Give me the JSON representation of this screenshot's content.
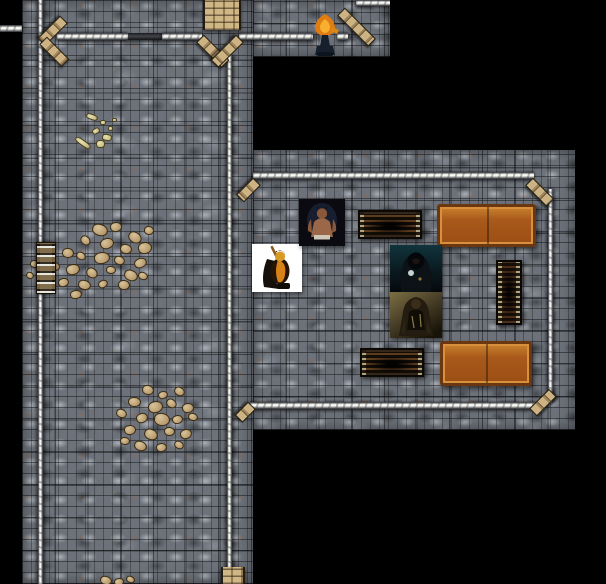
{
  "scene": {
    "kind": "dungeon-map",
    "width": 606,
    "height": 584,
    "background": "#000000",
    "grid": {
      "size": 32.7,
      "line_color": "rgba(8,9,11,0.48)"
    }
  },
  "palette": {
    "floor_stone": "#6d727a",
    "wall_highlight": "#ffffff",
    "wall_shadow": "#232428",
    "corner_wood": "#cdb284",
    "table_bright": "#a8591b",
    "table_dark": "#1d140c",
    "rubble_stone": "#b89a6e",
    "hero_background": "#ffffff",
    "flame_orange": "#f29a18"
  },
  "floors": [
    {
      "name": "west-hall-floor",
      "x": 22,
      "y": 0,
      "w": 231,
      "h": 584,
      "gx": 19,
      "gy": 30
    },
    {
      "name": "north-corridor-floor",
      "x": 253,
      "y": 0,
      "w": 137,
      "h": 57,
      "gx": 17,
      "gy": 30
    },
    {
      "name": "east-room-floor",
      "x": 253,
      "y": 150,
      "w": 322,
      "h": 280,
      "gx": 17,
      "gy": 11
    }
  ],
  "walls": [
    {
      "name": "west-edge-wall-stub",
      "x": 0,
      "y": 25,
      "w": 22,
      "h": 7,
      "o": "h"
    },
    {
      "name": "west-wall",
      "x": 38,
      "y": 0,
      "w": 5,
      "h": 584,
      "o": "v"
    },
    {
      "name": "north-wall-west",
      "x": 57,
      "y": 33,
      "w": 71,
      "h": 7,
      "o": "h"
    },
    {
      "name": "north-wall-gap-shadow",
      "x": 128,
      "y": 33,
      "w": 34,
      "h": 7,
      "o": "h",
      "dark": true
    },
    {
      "name": "north-wall-mid",
      "x": 162,
      "y": 33,
      "w": 40,
      "h": 7,
      "o": "h"
    },
    {
      "name": "north-wall-east",
      "x": 239,
      "y": 33,
      "w": 74,
      "h": 7,
      "o": "h"
    },
    {
      "name": "north-wall-far-east",
      "x": 337,
      "y": 33,
      "w": 11,
      "h": 7,
      "o": "h"
    },
    {
      "name": "north-edge-wall-stub",
      "x": 356,
      "y": 0,
      "w": 34,
      "h": 6,
      "o": "h"
    },
    {
      "name": "west-hall-east-wall",
      "x": 227,
      "y": 55,
      "w": 5,
      "h": 529,
      "o": "v"
    },
    {
      "name": "east-room-north-wall",
      "x": 253,
      "y": 172,
      "w": 281,
      "h": 7,
      "o": "h"
    },
    {
      "name": "east-room-east-wall",
      "x": 548,
      "y": 189,
      "w": 5,
      "h": 214,
      "o": "v"
    },
    {
      "name": "east-room-south-wall",
      "x": 250,
      "y": 402,
      "w": 286,
      "h": 7,
      "o": "h"
    }
  ],
  "diagonals": [
    {
      "name": "northwest-corner-upper",
      "x": 64,
      "y": 14,
      "len": 30,
      "deg": 135
    },
    {
      "name": "northwest-corner-lower",
      "x": 43,
      "y": 35,
      "len": 30,
      "deg": 45
    },
    {
      "name": "stair-funnel-west",
      "x": 200,
      "y": 33,
      "len": 34,
      "deg": 45
    },
    {
      "name": "stair-funnel-east",
      "x": 240,
      "y": 33,
      "len": 34,
      "deg": 135
    },
    {
      "name": "north-corridor-corner",
      "x": 341,
      "y": 6,
      "len": 42,
      "deg": 45
    },
    {
      "name": "east-room-nw-corner",
      "x": 257,
      "y": 176,
      "len": 22,
      "deg": 135
    },
    {
      "name": "east-room-ne-corner",
      "x": 529,
      "y": 176,
      "len": 28,
      "deg": 45
    },
    {
      "name": "east-room-se-corner",
      "x": 533,
      "y": 407,
      "len": 26,
      "deg": -45
    },
    {
      "name": "east-room-sw-corner",
      "x": 252,
      "y": 400,
      "len": 17,
      "deg": 135
    }
  ],
  "stairs": [
    {
      "name": "staircase-north",
      "x": 203,
      "y": 0,
      "w": 34,
      "h": 30
    },
    {
      "name": "staircase-south",
      "x": 221,
      "y": 567,
      "w": 20,
      "h": 17
    }
  ],
  "ladders": [
    {
      "name": "ladder-west-wall",
      "x": 36,
      "y": 242,
      "w": 18,
      "h": 50
    }
  ],
  "tokens": [
    {
      "id": "hero",
      "name": "hero-warrior-token",
      "desc": "armored warrior with raised sword on white tile",
      "x": 252,
      "y": 244,
      "w": 50,
      "h": 48
    },
    {
      "id": "brazier",
      "name": "flaming-statue-token",
      "desc": "orange flame statue on dark pedestal",
      "x": 310,
      "y": 13,
      "w": 30,
      "h": 44
    },
    {
      "id": "barbarian",
      "name": "barbarian-token",
      "desc": "shirtless barbarian portrait on dark tile",
      "x": 299,
      "y": 199,
      "w": 46,
      "h": 47
    },
    {
      "id": "hooded",
      "name": "hooded-figure-token",
      "desc": "hooded figure on teal-black tile",
      "x": 390,
      "y": 245,
      "w": 52,
      "h": 47
    },
    {
      "id": "brute",
      "name": "armored-brute-token",
      "desc": "dark armored brute on olive tile",
      "x": 390,
      "y": 292,
      "w": 52,
      "h": 46
    }
  ],
  "furniture": [
    {
      "type": "table-dark",
      "name": "weathered-table-north",
      "x": 358,
      "y": 210,
      "w": 60,
      "h": 25
    },
    {
      "type": "table-bright",
      "name": "wooden-table-north",
      "x": 437,
      "y": 204,
      "w": 93,
      "h": 37
    },
    {
      "type": "cabinet",
      "name": "cabinet-east",
      "x": 496,
      "y": 260,
      "w": 22,
      "h": 61
    },
    {
      "type": "table-dark",
      "name": "weathered-table-south",
      "x": 360,
      "y": 348,
      "w": 60,
      "h": 25
    },
    {
      "type": "table-bright",
      "name": "wooden-table-south",
      "x": 440,
      "y": 341,
      "w": 86,
      "h": 39
    }
  ],
  "rubble_patches": [
    {
      "name": "debris-scatter-north",
      "kind": "debris",
      "x": 72,
      "y": 112,
      "stones": [
        [
          14,
          2,
          10,
          4,
          20
        ],
        [
          28,
          8,
          4,
          3,
          0
        ],
        [
          36,
          14,
          3,
          3,
          0
        ],
        [
          20,
          16,
          6,
          4,
          -30
        ],
        [
          2,
          28,
          16,
          4,
          35
        ],
        [
          30,
          22,
          8,
          5,
          10
        ],
        [
          40,
          6,
          3,
          2,
          0
        ],
        [
          24,
          28,
          7,
          6,
          0
        ]
      ]
    },
    {
      "name": "rubble-pile-west",
      "kind": "rocks",
      "x": 50,
      "y": 222,
      "stones": [
        [
          -20,
          38,
          8,
          6,
          0
        ],
        [
          -24,
          50,
          6,
          5,
          20
        ],
        [
          42,
          2,
          14,
          10,
          15
        ],
        [
          60,
          0,
          10,
          8,
          -10
        ],
        [
          78,
          10,
          12,
          9,
          30
        ],
        [
          94,
          4,
          8,
          7,
          0
        ],
        [
          30,
          14,
          9,
          7,
          40
        ],
        [
          50,
          16,
          12,
          9,
          -20
        ],
        [
          70,
          22,
          10,
          8,
          10
        ],
        [
          88,
          20,
          12,
          10,
          -15
        ],
        [
          12,
          26,
          10,
          8,
          0
        ],
        [
          26,
          30,
          8,
          6,
          25
        ],
        [
          44,
          30,
          14,
          10,
          -10
        ],
        [
          64,
          34,
          9,
          7,
          15
        ],
        [
          84,
          36,
          11,
          8,
          -25
        ],
        [
          0,
          40,
          8,
          7,
          10
        ],
        [
          16,
          42,
          12,
          9,
          -15
        ],
        [
          36,
          46,
          10,
          8,
          30
        ],
        [
          56,
          44,
          8,
          6,
          0
        ],
        [
          74,
          48,
          12,
          9,
          20
        ],
        [
          8,
          56,
          9,
          7,
          -20
        ],
        [
          28,
          58,
          11,
          8,
          10
        ],
        [
          48,
          58,
          8,
          6,
          -30
        ],
        [
          68,
          58,
          10,
          8,
          0
        ],
        [
          88,
          50,
          8,
          6,
          15
        ],
        [
          20,
          68,
          10,
          7,
          -10
        ]
      ]
    },
    {
      "name": "rubble-pile-south",
      "kind": "rocks",
      "x": 108,
      "y": 385,
      "stones": [
        [
          34,
          0,
          10,
          8,
          10
        ],
        [
          50,
          6,
          8,
          6,
          -20
        ],
        [
          66,
          2,
          9,
          7,
          25
        ],
        [
          20,
          12,
          11,
          8,
          0
        ],
        [
          40,
          16,
          13,
          10,
          -15
        ],
        [
          58,
          14,
          9,
          7,
          30
        ],
        [
          74,
          18,
          10,
          8,
          -10
        ],
        [
          8,
          24,
          9,
          7,
          20
        ],
        [
          28,
          28,
          10,
          8,
          -25
        ],
        [
          46,
          28,
          14,
          11,
          5
        ],
        [
          64,
          30,
          9,
          7,
          -15
        ],
        [
          80,
          28,
          8,
          6,
          10
        ],
        [
          16,
          40,
          10,
          8,
          -10
        ],
        [
          36,
          44,
          12,
          9,
          20
        ],
        [
          56,
          42,
          9,
          7,
          0
        ],
        [
          72,
          44,
          10,
          8,
          -20
        ],
        [
          26,
          56,
          11,
          8,
          15
        ],
        [
          48,
          58,
          9,
          7,
          -10
        ],
        [
          66,
          56,
          8,
          6,
          25
        ],
        [
          12,
          52,
          8,
          6,
          0
        ]
      ]
    },
    {
      "name": "rubble-bits-bottom-edge",
      "kind": "rocks",
      "x": 98,
      "y": 574,
      "stones": [
        [
          2,
          2,
          10,
          7,
          10
        ],
        [
          16,
          4,
          8,
          6,
          -15
        ],
        [
          28,
          2,
          7,
          5,
          20
        ]
      ]
    }
  ]
}
